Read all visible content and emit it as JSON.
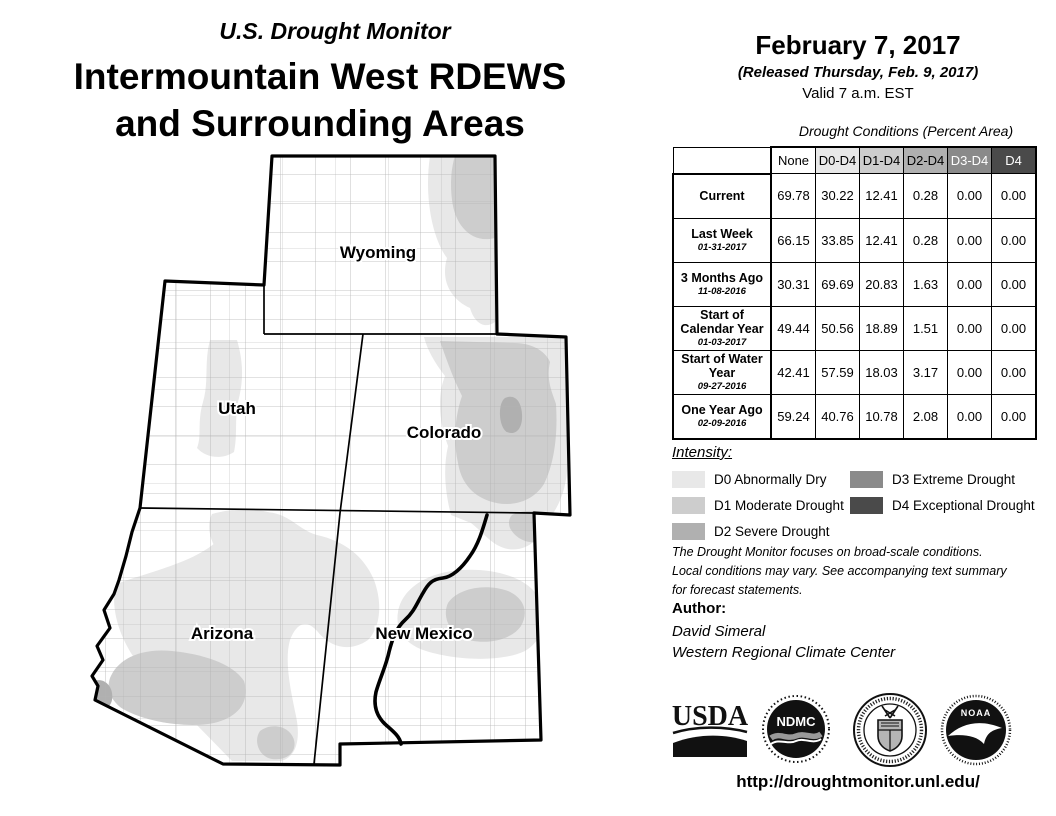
{
  "header": {
    "monitor_title": "U.S. Drought Monitor",
    "region_title_line1": "Intermountain West RDEWS",
    "region_title_line2": "and Surrounding Areas",
    "date": "February 7, 2017",
    "released": "(Released Thursday, Feb. 9, 2017)",
    "valid": "Valid 7 a.m. EST"
  },
  "drought_colors": {
    "d0": "#e8e8e8",
    "d1": "#cdcdcd",
    "d2": "#b0b0b0",
    "d3": "#8a8a8a",
    "d4": "#4a4a4a",
    "none_header": "#ffffff"
  },
  "table": {
    "title": "Drought Conditions (Percent Area)",
    "columns": [
      "None",
      "D0-D4",
      "D1-D4",
      "D2-D4",
      "D3-D4",
      "D4"
    ],
    "rows": [
      {
        "label": "Current",
        "date": "",
        "values": [
          "69.78",
          "30.22",
          "12.41",
          "0.28",
          "0.00",
          "0.00"
        ]
      },
      {
        "label": "Last Week",
        "date": "01-31-2017",
        "values": [
          "66.15",
          "33.85",
          "12.41",
          "0.28",
          "0.00",
          "0.00"
        ]
      },
      {
        "label": "3 Months Ago",
        "date": "11-08-2016",
        "values": [
          "30.31",
          "69.69",
          "20.83",
          "1.63",
          "0.00",
          "0.00"
        ]
      },
      {
        "label": "Start of Calendar Year",
        "date": "01-03-2017",
        "values": [
          "49.44",
          "50.56",
          "18.89",
          "1.51",
          "0.00",
          "0.00"
        ]
      },
      {
        "label": "Start of Water Year",
        "date": "09-27-2016",
        "values": [
          "42.41",
          "57.59",
          "18.03",
          "3.17",
          "0.00",
          "0.00"
        ]
      },
      {
        "label": "One Year Ago",
        "date": "02-09-2016",
        "values": [
          "59.24",
          "40.76",
          "10.78",
          "2.08",
          "0.00",
          "0.00"
        ]
      }
    ]
  },
  "legend": {
    "title": "Intensity:",
    "items": [
      {
        "label": "D0 Abnormally Dry"
      },
      {
        "label": "D1 Moderate Drought"
      },
      {
        "label": "D2 Severe Drought"
      },
      {
        "label": "D3 Extreme Drought"
      },
      {
        "label": "D4 Exceptional Drought"
      }
    ]
  },
  "disclaimer_lines": [
    "The Drought Monitor focuses on broad-scale conditions.",
    "Local conditions may vary. See accompanying text summary",
    "for forecast statements."
  ],
  "author": {
    "heading": "Author:",
    "name": "David Simeral",
    "org": "Western Regional Climate Center"
  },
  "logos": {
    "usda": {
      "label": "USDA"
    },
    "ndmc": {
      "label": "NDMC"
    },
    "noaa": {
      "label": "NOAA"
    }
  },
  "map": {
    "states": [
      {
        "label": "Wyoming"
      },
      {
        "label": "Utah"
      },
      {
        "label": "Colorado"
      },
      {
        "label": "Arizona"
      },
      {
        "label": "New Mexico"
      }
    ]
  },
  "footer": {
    "url": "http://droughtmonitor.unl.edu/"
  }
}
